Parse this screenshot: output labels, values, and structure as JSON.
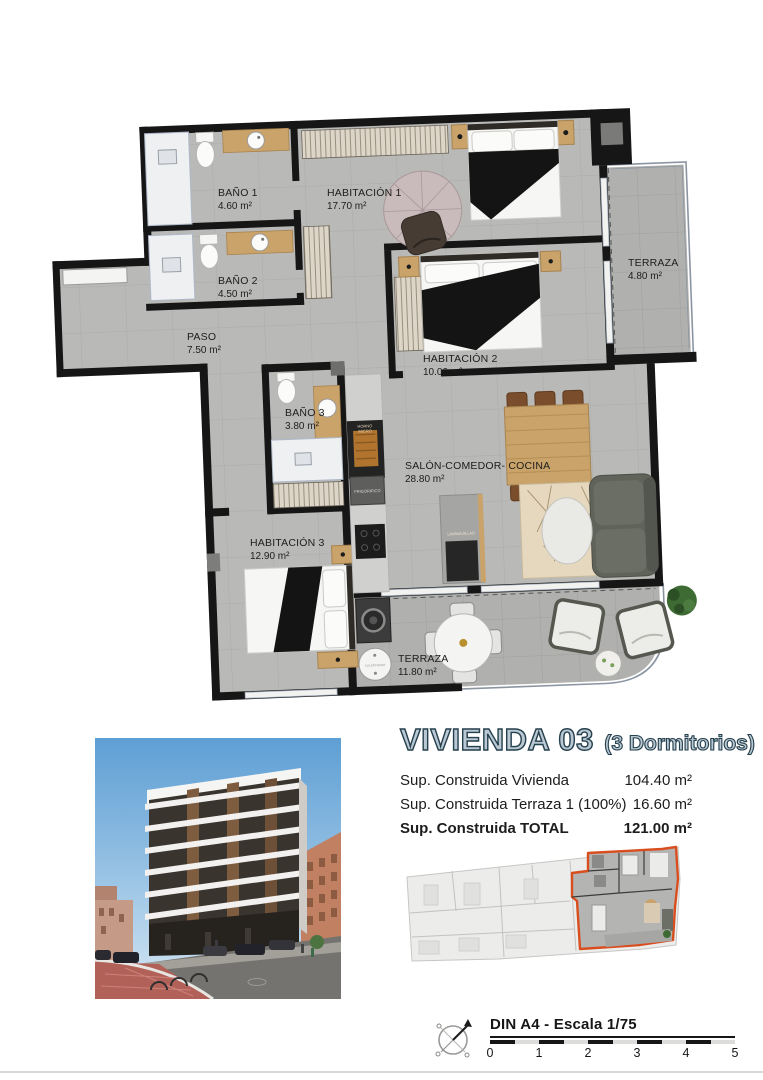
{
  "floorplan": {
    "rooms": [
      {
        "name": "BAÑO 1",
        "area": "4.60 m²"
      },
      {
        "name": "HABITACIÓN 1",
        "area": "17.70 m²"
      },
      {
        "name": "BAÑO 2",
        "area": "4.50 m²"
      },
      {
        "name": "PASO",
        "area": "7.50 m²"
      },
      {
        "name": "HABITACIÓN 2",
        "area": "10.00 m²"
      },
      {
        "name": "TERRAZA",
        "area": "4.80 m²"
      },
      {
        "name": "BAÑO 3",
        "area": "3.80 m²"
      },
      {
        "name": "SALÓN-COMEDOR- COCINA",
        "area": "28.80 m²"
      },
      {
        "name": "HABITACIÓN 3",
        "area": "12.90 m²"
      },
      {
        "name": "TERRAZA",
        "area": "11.80 m²"
      }
    ],
    "appliances": {
      "horno_line1": "HORNO",
      "horno_line2": "MICRO",
      "frigorifico": "FRIGORIFICO",
      "lavavajillas": "LAVAVAJILLAS",
      "calentador": "CALENTADOR"
    }
  },
  "info": {
    "title": "VIVIENDA 03",
    "subtitle": "(3 Dormitorios)",
    "rows": [
      {
        "label": "Sup. Construida Vivienda",
        "value": "104.40 m²"
      },
      {
        "label": "Sup. Construida Terraza 1 (100%)",
        "value": "16.60 m²"
      },
      {
        "label": "Sup. Construida TOTAL",
        "value": "121.00 m²"
      }
    ]
  },
  "footer": {
    "scale_label": "DIN A4 - Escala 1/75",
    "ticks": [
      "0",
      "1",
      "2",
      "3",
      "4",
      "5"
    ]
  },
  "icons": {
    "compass": "north-arrow-compass-icon"
  },
  "colors": {
    "title_fill": "#b9c8d2",
    "title_outline": "#26414e",
    "keyplan_highlight": "#d94e1f",
    "wall": "#161616",
    "floor": "#b9b9b7",
    "terrace_floor": "#b0b0ae",
    "wood": "#c9a36a"
  }
}
